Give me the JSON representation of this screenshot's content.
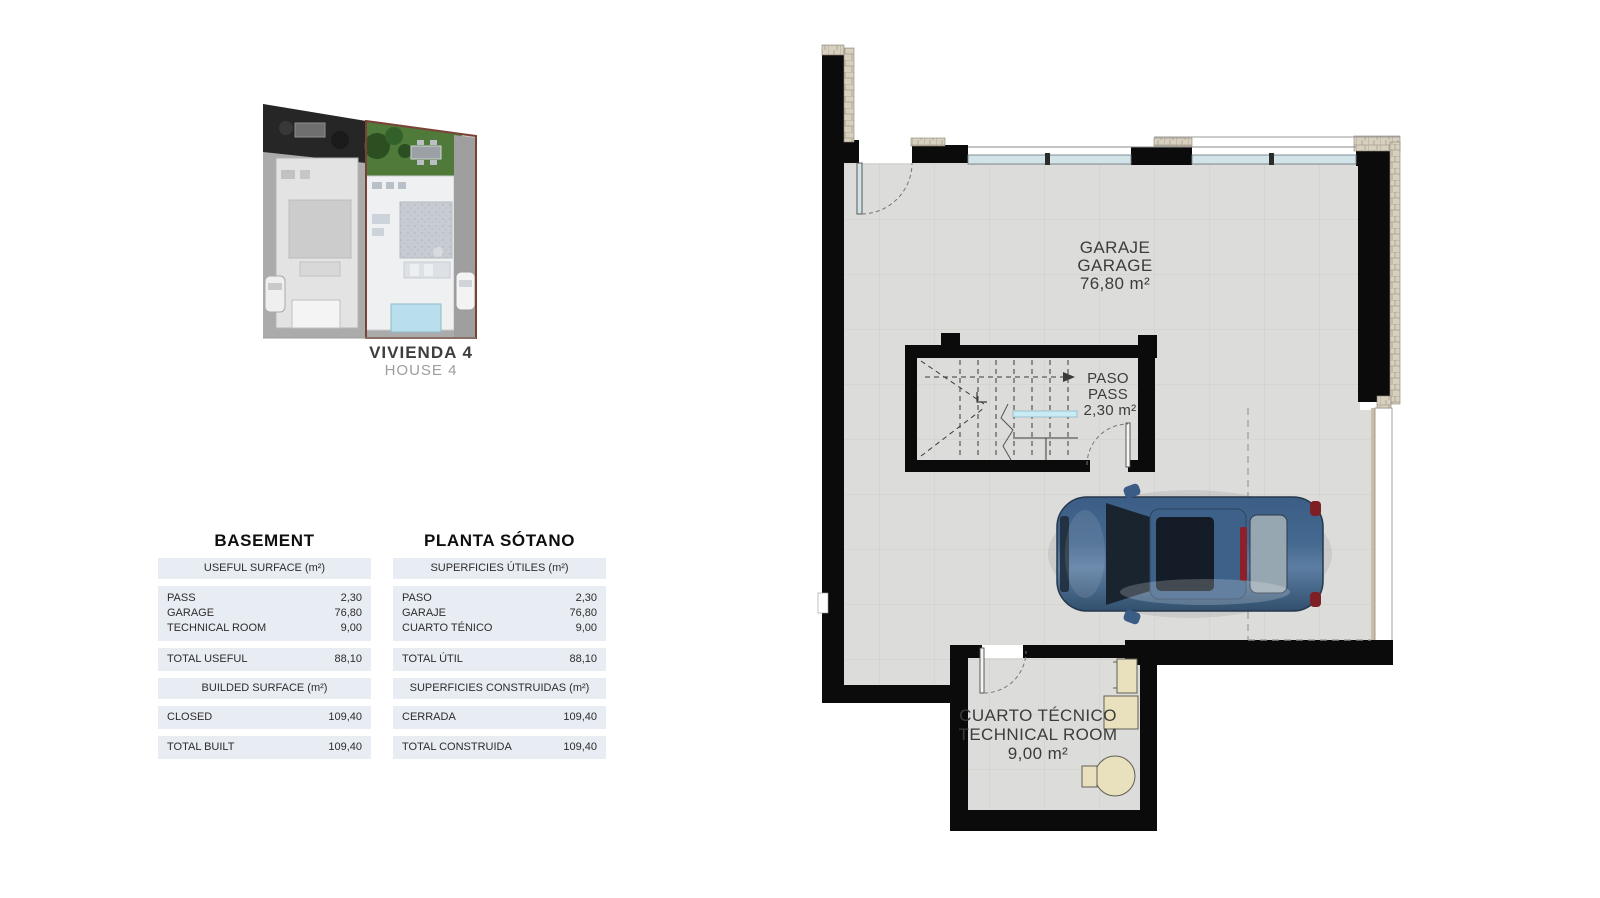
{
  "site_plan": {
    "title": "VIVIENDA 4",
    "subtitle": "HOUSE 4"
  },
  "tables": {
    "english": {
      "title": "BASEMENT",
      "useful_header": "USEFUL SURFACE (m²)",
      "rows": [
        {
          "label": "PASS",
          "value": "2,30"
        },
        {
          "label": "GARAGE",
          "value": "76,80"
        },
        {
          "label": "TECHNICAL ROOM",
          "value": "9,00"
        }
      ],
      "total_useful_label": "TOTAL USEFUL",
      "total_useful_value": "88,10",
      "built_header": "BUILDED SURFACE (m²)",
      "closed_label": "CLOSED",
      "closed_value": "109,40",
      "total_built_label": "TOTAL BUILT",
      "total_built_value": "109,40"
    },
    "spanish": {
      "title": "PLANTA SÓTANO",
      "useful_header": "SUPERFICIES ÚTILES (m²)",
      "rows": [
        {
          "label": "PASO",
          "value": "2,30"
        },
        {
          "label": "GARAJE",
          "value": "76,80"
        },
        {
          "label": "CUARTO TÉNICO",
          "value": "9,00"
        }
      ],
      "total_useful_label": "TOTAL ÚTIL",
      "total_useful_value": "88,10",
      "built_header": "SUPERFICIES CONSTRUIDAS (m²)",
      "closed_label": "CERRADA",
      "closed_value": "109,40",
      "total_built_label": "TOTAL CONSTRUIDA",
      "total_built_value": "109,40"
    }
  },
  "floor_plan": {
    "garage": {
      "name_es": "GARAJE",
      "name_en": "GARAGE",
      "area": "76,80 m²"
    },
    "pass": {
      "name_es": "PASO",
      "name_en": "PASS",
      "area": "2,30 m²"
    },
    "technical_room": {
      "name_es": "CUARTO TÉCNICO",
      "name_en": "TECHNICAL ROOM",
      "area": "9,00 m²"
    }
  },
  "colors": {
    "wall": "#0b0b0b",
    "floor": "#dcdcda",
    "stone_facing": "#d8d0bf",
    "window_glass": "#d3e4e9",
    "table_band": "#e8ecf3",
    "highlight_border": "#7c4136",
    "garden_green": "#4f7a3a",
    "pool_blue": "#b9dfec",
    "car_body_blue": "#41658d",
    "equipment_beige": "#e9e1bd"
  }
}
